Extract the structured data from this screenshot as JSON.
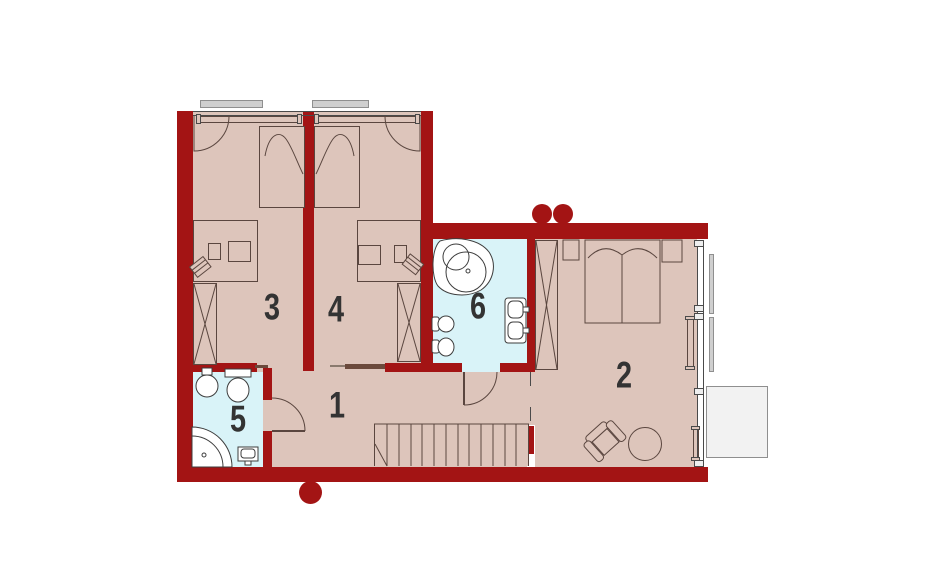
{
  "floorplan": {
    "room_labels": {
      "hall": "1",
      "bedroom_right": "2",
      "bedroom_left": "3",
      "bedroom_mid": "4",
      "bath_small": "5",
      "bath_main": "6"
    },
    "colors": {
      "wall": "#a31414",
      "floor": "#ddc5bb",
      "bath_floor": "#d9f3f8",
      "sill": "#cfcfcf",
      "balcony": "#f2f2f2",
      "outline": "#5a463f",
      "fixture_fill": "#ffffff",
      "door_leaf": "#6b4a3c",
      "label": "#333333"
    }
  }
}
